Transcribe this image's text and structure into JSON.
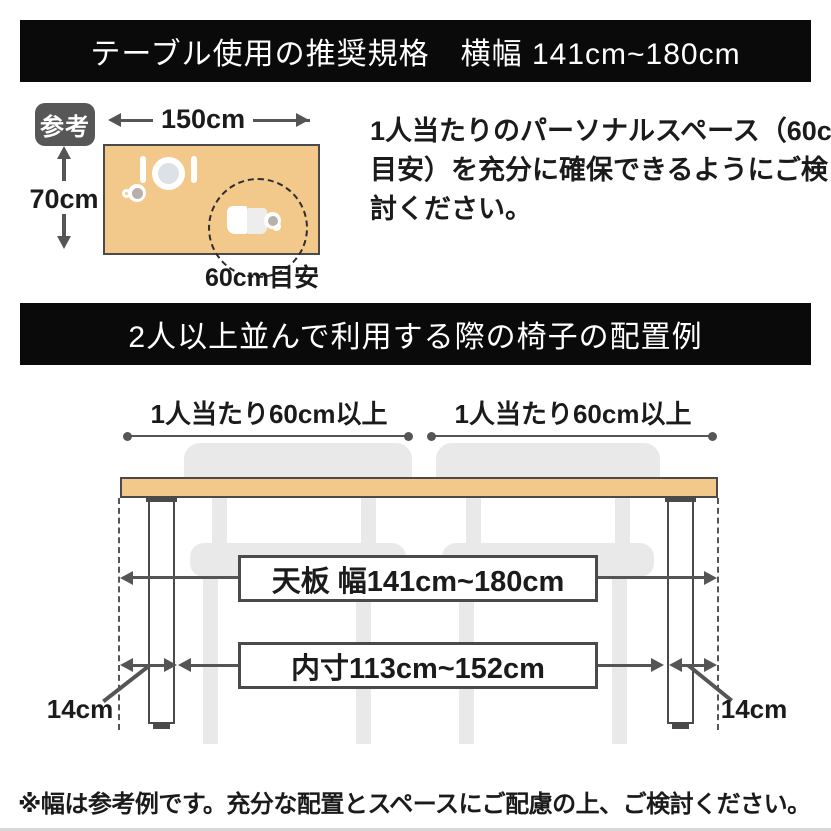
{
  "banner_top": {
    "title": "テーブル使用の推奨規格　横幅 141cm~180cm"
  },
  "reference": {
    "badge_label": "参考",
    "width_dim": "150cm",
    "depth_dim": "70cm",
    "personal_space_label": "60cm目安",
    "description_lines": [
      "1人当たりのパーソナルスペース（60cm",
      "目安）を充分に確保できるようにご検",
      "討ください。"
    ]
  },
  "banner_chairs": {
    "title": "2人以上並んで利用する際の椅子の配置例"
  },
  "chair_diagram": {
    "per_person_left": "1人当たり60cm以上",
    "per_person_right": "1人当たり60cm以上",
    "tabletop_dim": "天板 幅141cm~180cm",
    "inner_dim": "内寸113cm~152cm",
    "leg_inset_left": "14cm",
    "leg_inset_right": "14cm"
  },
  "footnote": "※幅は参考例です。充分な配置とスペースにご配慮の上、ご検討ください。",
  "colors": {
    "banner_bg": "#0a0a0a",
    "tabletop": "#f3c98b",
    "line_gray": "#555555",
    "chair_gray": "#e9e9e9",
    "badge_bg": "#575757"
  }
}
